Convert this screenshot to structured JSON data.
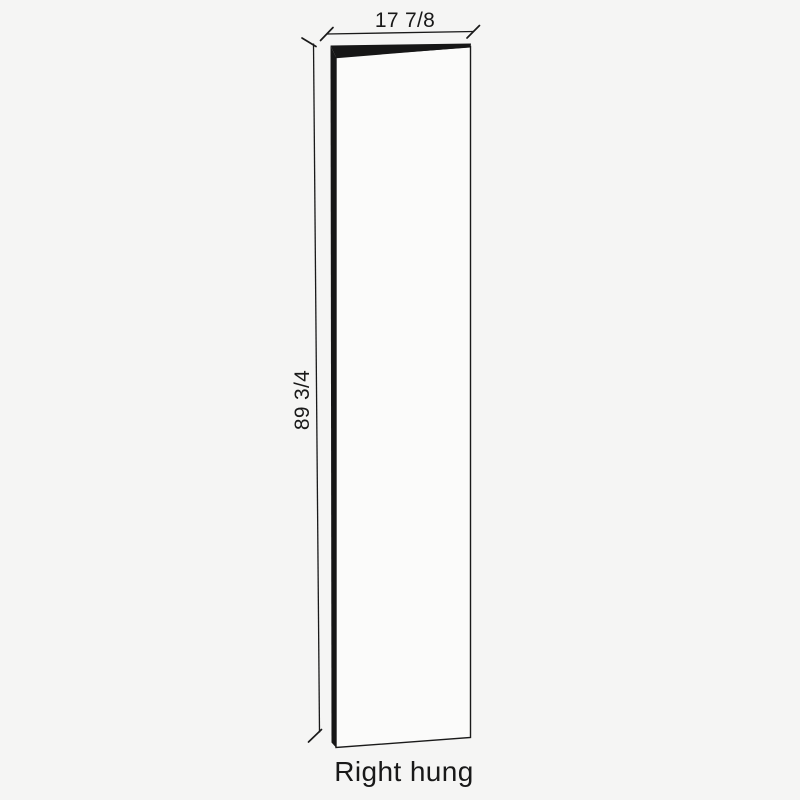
{
  "diagram": {
    "caption": "Right hung",
    "width_dimension": "17 7/8",
    "height_dimension": "89 3/4",
    "colors": {
      "background": "#F5F5F4",
      "line": "#1A1A1A",
      "door_face": "#FBFBFA",
      "door_edge": "#161616",
      "text": "#191919"
    }
  }
}
